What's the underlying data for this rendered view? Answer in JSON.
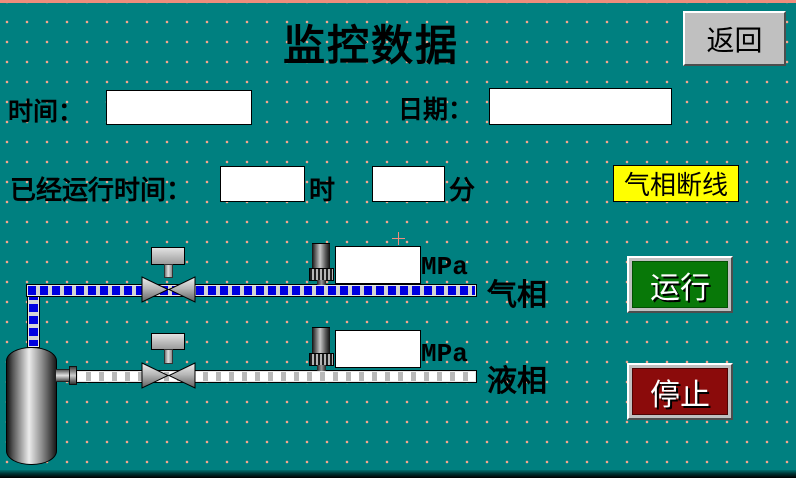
{
  "header": {
    "title": "监控数据",
    "back_button": "返回"
  },
  "fields": {
    "time": {
      "label": "时间：",
      "value": ""
    },
    "date": {
      "label": "日期：",
      "value": ""
    },
    "runtime": {
      "label": "已经运行时间：",
      "hours_value": "",
      "hours_unit": "时",
      "minutes_value": "",
      "minutes_unit": "分"
    }
  },
  "alarm": {
    "text": "气相断线",
    "bg_color": "#ffff00"
  },
  "gas_line": {
    "label": "气相",
    "pressure_value": "",
    "unit": "MPa"
  },
  "liquid_line": {
    "label": "液相",
    "pressure_value": "",
    "unit": "MPa"
  },
  "controls": {
    "run": "运行",
    "stop": "停止"
  },
  "colors": {
    "background": "#008080",
    "grid_dots": "#f2a58f",
    "gas_pipe": "#0000e0",
    "run_button": "#087808",
    "stop_button": "#8b0b0b",
    "alarm_bg": "#ffff00",
    "back_button_bg": "#c0c0c0"
  }
}
